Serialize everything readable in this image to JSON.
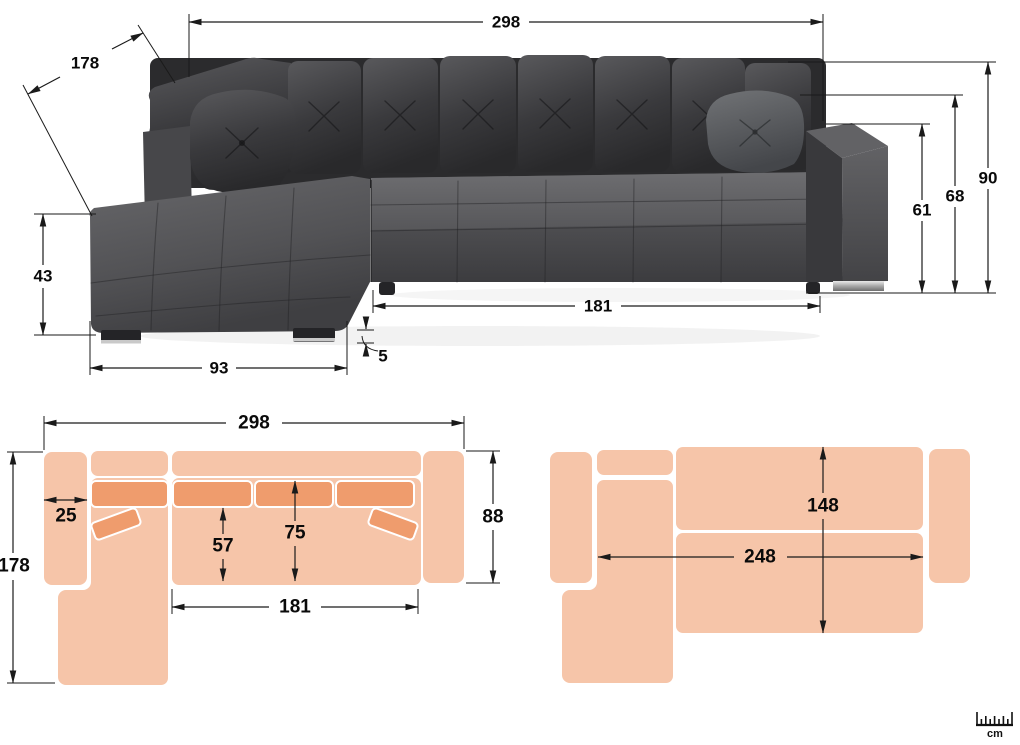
{
  "photo_view": {
    "total_width": "298",
    "total_depth": "178",
    "back_height": "90",
    "cushion_height": "68",
    "armrest_height": "61",
    "seat_height": "43",
    "chaise_width": "93",
    "leg_height": "5",
    "seat_length": "181"
  },
  "plan_view": {
    "total_width": "298",
    "total_depth": "178",
    "armrest_width": "25",
    "seat_depth": "57",
    "seat_depth_with_back": "75",
    "seat_length": "181",
    "body_depth": "88"
  },
  "bed_view": {
    "mattress_length": "248",
    "mattress_width": "148"
  },
  "ruler": {
    "unit": "cm"
  },
  "colors": {
    "plan_fill": "#f6c5a9",
    "plan_cushion_fill": "#ef9c6d",
    "dimension_line": "#1a1a1a"
  }
}
